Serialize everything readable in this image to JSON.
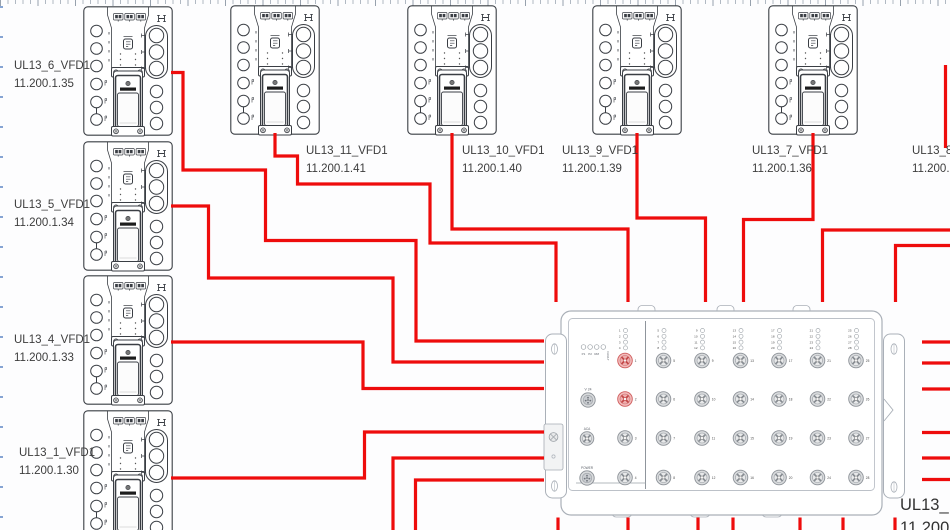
{
  "diagram": {
    "devices": [
      {
        "name": "UL13_6_VFD1",
        "ip": "11.200.1.35"
      },
      {
        "name": "UL13_5_VFD1",
        "ip": "11.200.1.34"
      },
      {
        "name": "UL13_4_VFD1",
        "ip": "11.200.1.33"
      },
      {
        "name": "UL13_1_VFD1",
        "ip": "11.200.1.30"
      },
      {
        "name": "UL13_11_VFD1",
        "ip": "11.200.1.41"
      },
      {
        "name": "UL13_10_VFD1",
        "ip": "11.200.1.40"
      },
      {
        "name": "UL13_9_VFD1",
        "ip": "11.200.1.39"
      },
      {
        "name": "UL13_7_VFD1",
        "ip": "11.200.1.36"
      },
      {
        "name": "UL13_8_",
        "ip": "11.200.1"
      }
    ],
    "switch": {
      "name": "UL13_",
      "ip": "11.200",
      "status_leds": [
        "P1",
        "P2",
        "RM",
        "FAULT"
      ],
      "aux_ports": [
        "V 24",
        "ACA",
        "POWER"
      ],
      "port_count": 28,
      "ports_per_column": 4,
      "highlighted_ports": [
        1,
        2
      ]
    },
    "colors": {
      "cable": "#ee0c0c",
      "port_highlight_fill": "#f2bcbc",
      "port_highlight_stroke": "#cf5b5b"
    }
  }
}
